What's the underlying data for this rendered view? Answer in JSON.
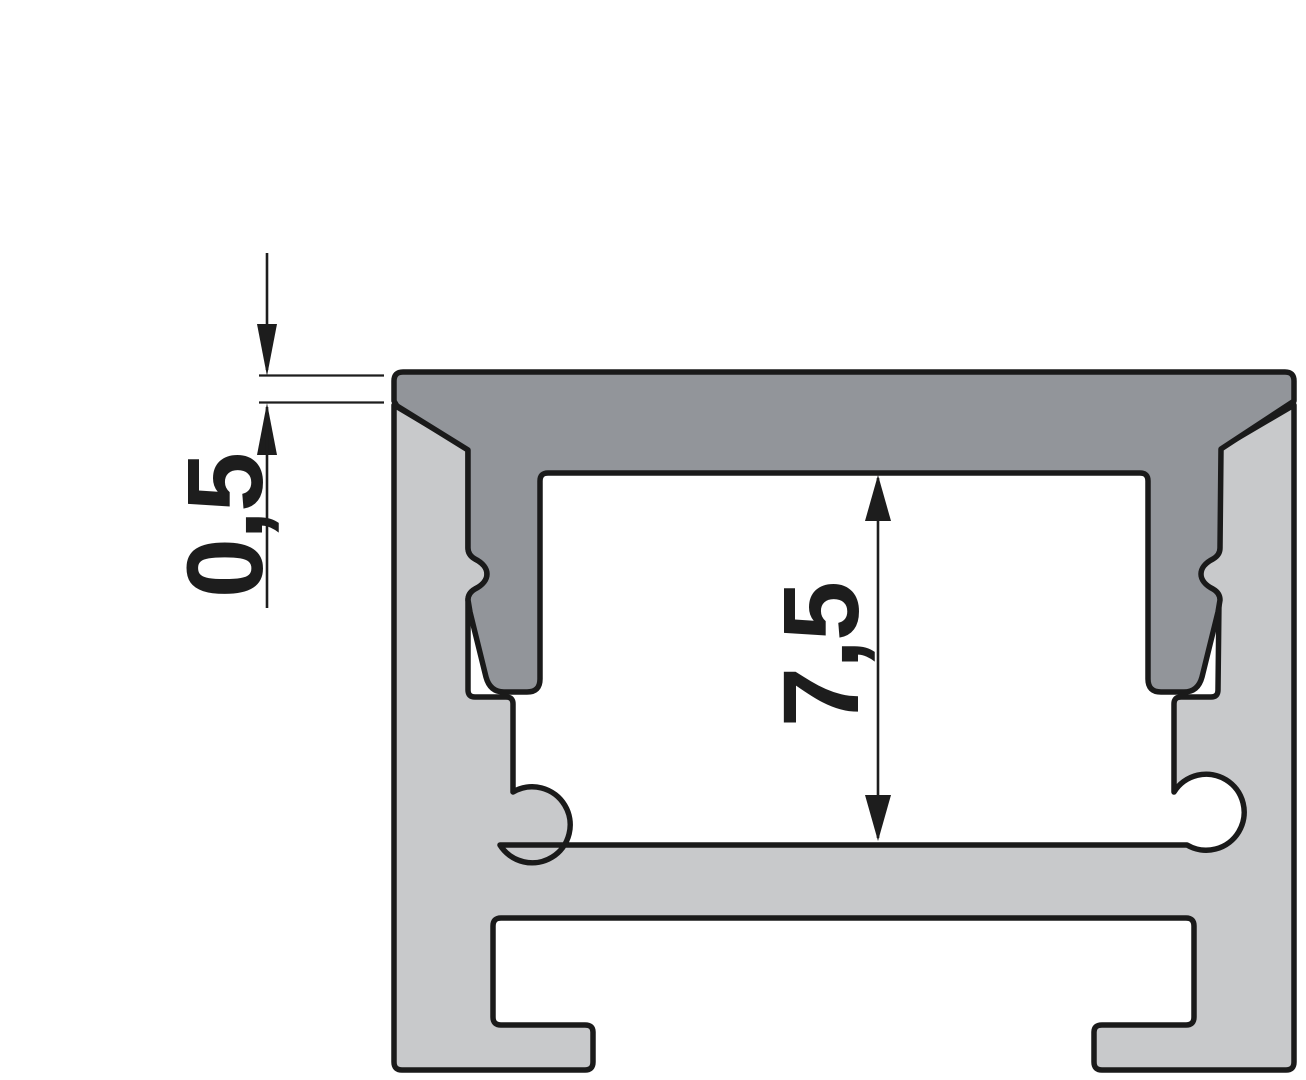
{
  "drawing": {
    "labels": {
      "dim_cover_protrusion": "0,5",
      "dim_inner_height": "7,5"
    },
    "colors": {
      "background": "#ffffff",
      "profile_fill": "#c8c9cb",
      "cover_fill": "#92959a",
      "outline": "#1a1a1a",
      "dimension": "#1d1d1d"
    }
  }
}
